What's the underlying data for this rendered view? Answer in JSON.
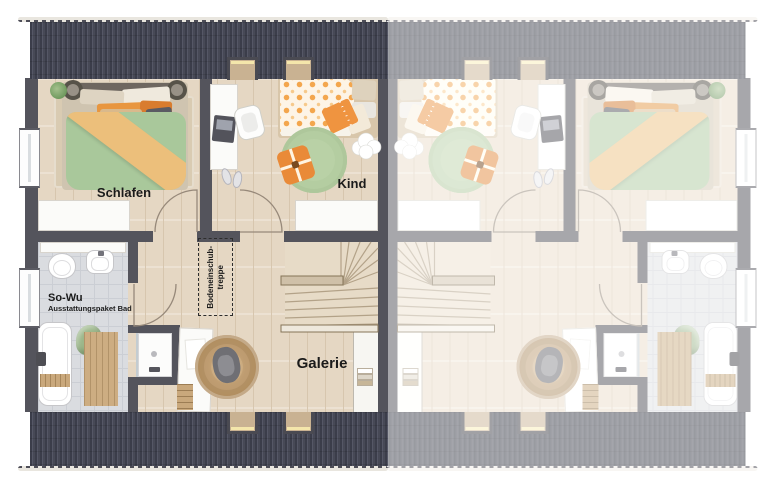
{
  "title": "Dachgeschoss-Grundriss Doppelhaus",
  "labels": {
    "schlafen": "Schlafen",
    "kind": "Kind",
    "galerie": "Galerie",
    "bad_package_title": "So-Wu",
    "bad_package_subtitle": "Ausstattungspaket Bad",
    "attic_stairs_line1": "Bodeneinschub-",
    "attic_stairs_line2": "treppe"
  },
  "units": {
    "left": {
      "style": "full-color",
      "rooms": [
        {
          "id": "schlafen",
          "label": "Schlafen",
          "features": [
            "double-bed",
            "bedside-tables",
            "area-rug",
            "plant",
            "built-in-closet",
            "window",
            "door"
          ]
        },
        {
          "id": "kind",
          "label": "Kind",
          "features": [
            "kids-bed",
            "desk",
            "laptop",
            "desk-chair",
            "round-rug",
            "floor-cushion",
            "cloud-pillow",
            "slippers",
            "dresser",
            "dormer-window",
            "door"
          ]
        },
        {
          "id": "bad",
          "label": "So-Wu Ausstattungspaket Bad",
          "features": [
            "toilet",
            "washbasin",
            "bathtub",
            "bath-caddy",
            "shower",
            "bath-mat",
            "towel",
            "window",
            "door"
          ]
        },
        {
          "id": "galerie",
          "label": "Galerie",
          "features": [
            "winder-staircase",
            "handrails",
            "attic-hatch-annotation",
            "desk",
            "desk-chair",
            "jute-rug",
            "dormer-windows"
          ]
        }
      ]
    },
    "right": {
      "style": "faded-mirror",
      "rooms": "identical mirrored layout, no labels"
    }
  },
  "colors": {
    "background": "#ffffff",
    "text": "#1b1b1b",
    "roof_dark": "#474956",
    "roof_rib": "#3b3d4a",
    "roof_rib_light": "#555766",
    "wall": "#54545c",
    "wood_floor": "#e5d7c3",
    "plank_line": "#d7c6ae",
    "tile_floor": "#dadce0",
    "tile_line": "#cbced4",
    "white_furniture": "#fbfbf9",
    "bed_green": "#a9c89b",
    "throw_orange": "#ecbf7b",
    "accent_orange": "#e98a38",
    "kids_duvet_dot": "#f3a64d",
    "rug_beige": "#d9cbb2",
    "rug_green": "#b9d1a6",
    "rug_jute": "#c9a87c",
    "stair_wood": "#e7dbc7"
  }
}
